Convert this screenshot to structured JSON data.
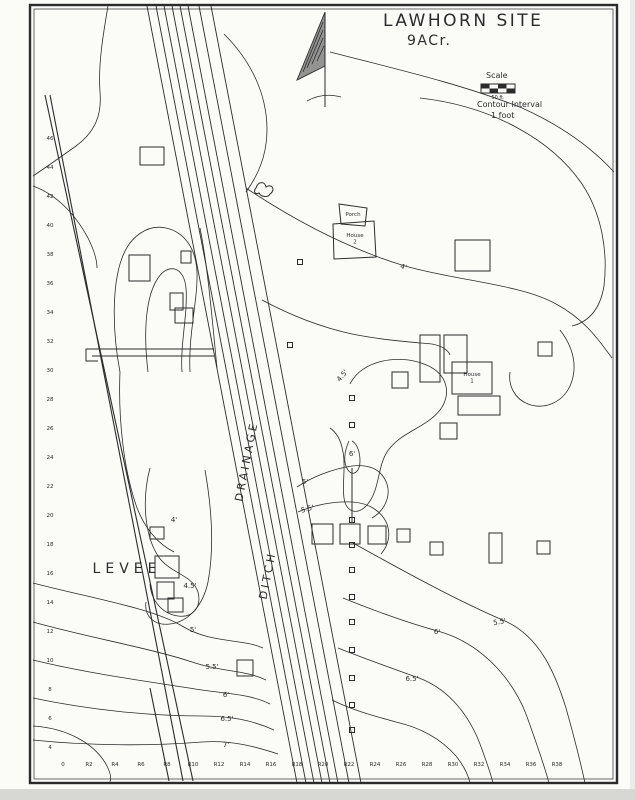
{
  "title": {
    "line1": "LAWHORN SITE",
    "line2": "9ACr."
  },
  "legend": {
    "scale_label": "Scale",
    "scale_caption": "50 ft.",
    "interval_label": "Contour Interval",
    "interval_value": "1 foot"
  },
  "colors": {
    "ink": "#2b2b2b",
    "paper": "#fbfbf8"
  },
  "map_labels": [
    {
      "name": "levee-label",
      "text": "LEVEE",
      "x": 127,
      "y": 573,
      "size": 14,
      "rot": 0,
      "ls": 5
    },
    {
      "name": "drainage-label",
      "text": "DRAINAGE",
      "x": 250,
      "y": 462,
      "size": 11,
      "rot": -79,
      "ls": 3
    },
    {
      "name": "ditch-label",
      "text": "DITCH",
      "x": 271,
      "y": 576,
      "size": 11,
      "rot": -79,
      "ls": 3
    }
  ],
  "contour_labels": [
    {
      "text": "4'",
      "x": 403,
      "y": 269,
      "rot": 15
    },
    {
      "text": "4'",
      "x": 174,
      "y": 522,
      "rot": 0
    },
    {
      "text": "4.5'",
      "x": 190,
      "y": 588,
      "rot": 0
    },
    {
      "text": "4.5'",
      "x": 344,
      "y": 377,
      "rot": -50
    },
    {
      "text": "5'",
      "x": 305,
      "y": 484,
      "rot": 0
    },
    {
      "text": "5.5'",
      "x": 308,
      "y": 511,
      "rot": -15
    },
    {
      "text": "6'",
      "x": 352,
      "y": 456,
      "rot": 0
    },
    {
      "text": "5'",
      "x": 193,
      "y": 632,
      "rot": 0
    },
    {
      "text": "5.5'",
      "x": 212,
      "y": 669,
      "rot": 0
    },
    {
      "text": "6'",
      "x": 226,
      "y": 697,
      "rot": 0
    },
    {
      "text": "6.5'",
      "x": 227,
      "y": 721,
      "rot": 0
    },
    {
      "text": "7'",
      "x": 226,
      "y": 747,
      "rot": 0
    },
    {
      "text": "5.5'",
      "x": 500,
      "y": 624,
      "rot": -10
    },
    {
      "text": "6'",
      "x": 437,
      "y": 634,
      "rot": 0
    },
    {
      "text": "6.5'",
      "x": 412,
      "y": 681,
      "rot": 0
    }
  ],
  "houses": [
    {
      "lines": [
        "House",
        "2"
      ],
      "x": 355,
      "y": 237
    },
    {
      "lines": [
        "Porch"
      ],
      "x": 353,
      "y": 216
    },
    {
      "lines": [
        "House",
        "1"
      ],
      "x": 472,
      "y": 376
    }
  ],
  "axes": {
    "left": {
      "labels": [
        "46",
        "44",
        "42",
        "40",
        "38",
        "36",
        "34",
        "32",
        "30",
        "28",
        "26",
        "24",
        "22",
        "20",
        "18",
        "16",
        "14",
        "12",
        "10",
        "8",
        "6",
        "4"
      ],
      "x": 50,
      "y0": 140,
      "dy": 29
    },
    "bottom": {
      "labels": [
        "0",
        "R2",
        "R4",
        "R6",
        "R8",
        "R10",
        "R12",
        "R14",
        "R16",
        "R18",
        "R20",
        "R22",
        "R24",
        "R26",
        "R28",
        "R30",
        "R32",
        "R34",
        "R36",
        "R38"
      ],
      "y": 766,
      "x0": 63,
      "dx": 26
    }
  },
  "geometry": {
    "frame": {
      "x": 30,
      "y": 5,
      "w": 587,
      "h": 778
    },
    "levee": [
      "M 45,95 L 193,781",
      "M 50,95 L 183,781",
      "M 150,688 L 169,781"
    ],
    "ditch": {
      "x1": 147,
      "y1": 6,
      "x2": 297,
      "y2": 783,
      "offsets": [
        0,
        9,
        17,
        25,
        33,
        41,
        52,
        64
      ]
    },
    "contours": [
      "M 108,6 C 103,35 98,65 100,92 C 102,115 95,132 76,146 C 62,156 48,166 33,176",
      "M 33,186 C 55,194 74,212 88,238 C 94,250 97,260 97,268",
      "M 120,372 C 112,330 112,285 122,258 C 130,236 148,224 166,228 C 184,232 196,248 197,272 C 198,300 188,335 190,372",
      "M 148,372 C 143,330 146,296 158,278 C 168,263 184,266 186,288 C 188,314 180,344 182,372",
      "M 200,228 C 208,268 212,318 217,368",
      "M 120,372 C 118,420 124,470 136,505 C 144,528 158,544 174,552",
      "M 150,468 C 142,498 144,534 158,556 C 170,574 192,574 198,592 C 202,608 192,618 178,616 C 162,614 151,600 150,584",
      "M 205,470 C 212,510 214,550 208,582 C 203,606 188,622 170,624 C 154,626 144,616 146,602",
      "M 33,583 C 90,598 152,608 182,626 C 212,644 240,638 263,648",
      "M 33,622 C 90,638 150,648 192,662 C 222,672 246,670 266,680",
      "M 33,660 C 90,674 152,682 202,690 C 228,694 250,694 270,704",
      "M 33,698 C 90,710 150,716 202,716 C 230,716 252,720 274,730",
      "M 33,740 C 90,746 152,746 202,742 C 230,740 254,746 278,754",
      "M 33,726 C 66,728 95,743 107,766 C 112,776 111,781 109,783",
      "M 246,188 C 300,224 352,250 405,266 C 458,281 520,284 556,304 C 586,320 600,342 612,358",
      "M 330,52 C 392,68 462,84 522,108 C 562,126 592,148 614,172",
      "M 420,98 C 492,106 552,140 582,184 C 602,214 608,252 604,286 C 600,310 588,322 572,326",
      "M 224,34 C 252,62 267,95 267,130 C 267,158 256,178 246,192",
      "M 350,384 C 362,360 398,354 424,364 C 448,373 452,394 440,410 C 426,428 400,432 387,452 C 377,468 380,490 367,505 C 357,516 346,512 344,498 C 342,483 346,466 343,452 C 341,440 336,432 330,428",
      "M 297,487 C 312,477 332,469 352,466 C 370,464 382,470 387,484 C 391,497 384,511 372,518",
      "M 298,512 C 314,505 334,501 352,502 C 370,503 382,512 387,524 C 391,535 388,546 381,554",
      "M 353,543 C 405,572 460,602 505,621 C 541,637 556,676 566,708 C 573,733 580,760 585,783",
      "M 343,598 C 380,613 412,624 441,632 C 481,644 512,678 526,714 C 536,742 544,764 549,783",
      "M 338,648 C 368,660 394,669 419,678 C 451,690 470,718 480,744 C 487,763 491,774 493,783",
      "M 332,700 C 352,710 374,716 396,722 C 422,728 442,740 456,756 C 464,766 468,774 470,783",
      "M 262,300 C 290,315 320,327 352,334 C 382,340 410,342 432,344 C 442,346 448,350 450,355",
      "M 560,330 C 574,348 578,368 570,386 C 562,403 544,410 528,404 C 515,399 508,386 510,372",
      "M 349,441 C 344,452 343,463 348,470 C 353,477 360,472 360,461 C 360,450 356,443 352,441"
    ],
    "buildings": [
      [
        140,
        147,
        24,
        18
      ],
      [
        129,
        255,
        21,
        26
      ],
      [
        181,
        251,
        10,
        12
      ],
      [
        170,
        293,
        13,
        17
      ],
      [
        175,
        308,
        18,
        15
      ],
      [
        455,
        240,
        35,
        31
      ],
      [
        420,
        335,
        20,
        47
      ],
      [
        444,
        335,
        23,
        38
      ],
      [
        452,
        362,
        40,
        32
      ],
      [
        458,
        396,
        42,
        19
      ],
      [
        392,
        372,
        16,
        16
      ],
      [
        440,
        423,
        17,
        16
      ],
      [
        538,
        342,
        14,
        14
      ],
      [
        312,
        524,
        21,
        20
      ],
      [
        340,
        524,
        20,
        20
      ],
      [
        368,
        526,
        18,
        18
      ],
      [
        397,
        529,
        13,
        13
      ],
      [
        430,
        542,
        13,
        13
      ],
      [
        489,
        533,
        13,
        30
      ],
      [
        537,
        541,
        13,
        13
      ],
      [
        155,
        556,
        24,
        22
      ],
      [
        157,
        582,
        17,
        17
      ],
      [
        168,
        598,
        15,
        14
      ],
      [
        237,
        660,
        16,
        16
      ],
      [
        150,
        527,
        14,
        12
      ]
    ],
    "polygons": [
      "M 333,224 L 374,221 L 376,257 L 334,259 Z",
      "M 339,204 L 367,208 L 365,226 L 341,224 Z"
    ],
    "stakes": {
      "x": 352,
      "ys": [
        398,
        425,
        520,
        545,
        570,
        597,
        622,
        650,
        678,
        705,
        730
      ],
      "size": 5,
      "extra": [
        [
          300,
          262
        ],
        [
          290,
          345
        ]
      ]
    },
    "misc": [
      "M 92,349 L 214,349",
      "M 92,356 L 214,356",
      "M 98,349 L 86,349 L 86,361 L 98,361",
      "M 352,468 L 352,522",
      "M 256,188 c 2,-7 9,-7 10,-1 c 6,-4 10,3 4,7 c -2,4 -9,3 -11,-1 c -4,2 -6,-2 -3,-5"
    ],
    "north_arrow": {
      "line": "M 325,12 L 325,107",
      "flag": "M 325,12 L 297,80 L 325,66 Z",
      "hatch": [
        "M 323,22 L 303,72",
        "M 323,30 L 307,68",
        "M 323,38 L 312,64",
        "M 324,46 L 317,61"
      ],
      "base": "M 307,101 Q 323,92 341,97"
    },
    "scalebar": {
      "x": 481,
      "y": 84,
      "w": 34,
      "h": 9
    }
  }
}
